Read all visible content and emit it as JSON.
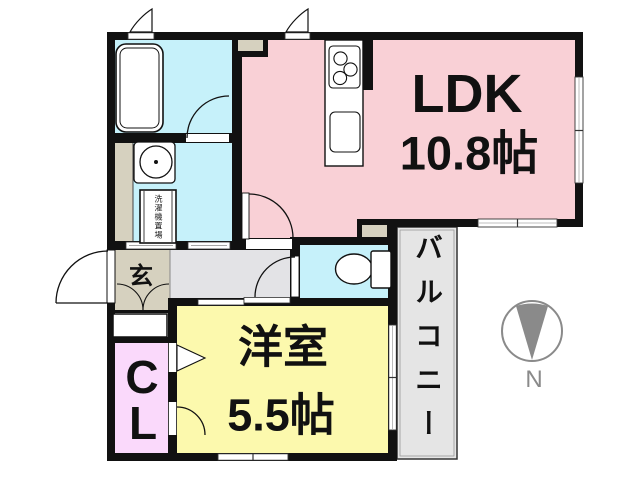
{
  "plan": {
    "ldk": {
      "name": "LDK",
      "size": "10.8帖",
      "color": "#f9d0d6"
    },
    "western_room": {
      "name": "洋室",
      "size": "5.5帖",
      "color": "#fcf9ad"
    },
    "entrance": {
      "label": "玄",
      "color": "#d6d1bf"
    },
    "closet": {
      "letter1": "C",
      "letter2": "L",
      "color": "#fad9fb"
    },
    "balcony": {
      "label": "バルコニー",
      "color": "#e5e5e5"
    },
    "bathroom": {
      "color": "#c6f1fa"
    },
    "washroom": {
      "color": "#c6f1fa",
      "washing_machine_label": "洗濯機置場"
    },
    "toilet": {
      "color": "#c6f1fa"
    },
    "hallway": {
      "color": "#e3e3e6"
    },
    "compass": {
      "label": "N",
      "color": "#8a8a8a"
    },
    "wall_color": "#111111"
  }
}
